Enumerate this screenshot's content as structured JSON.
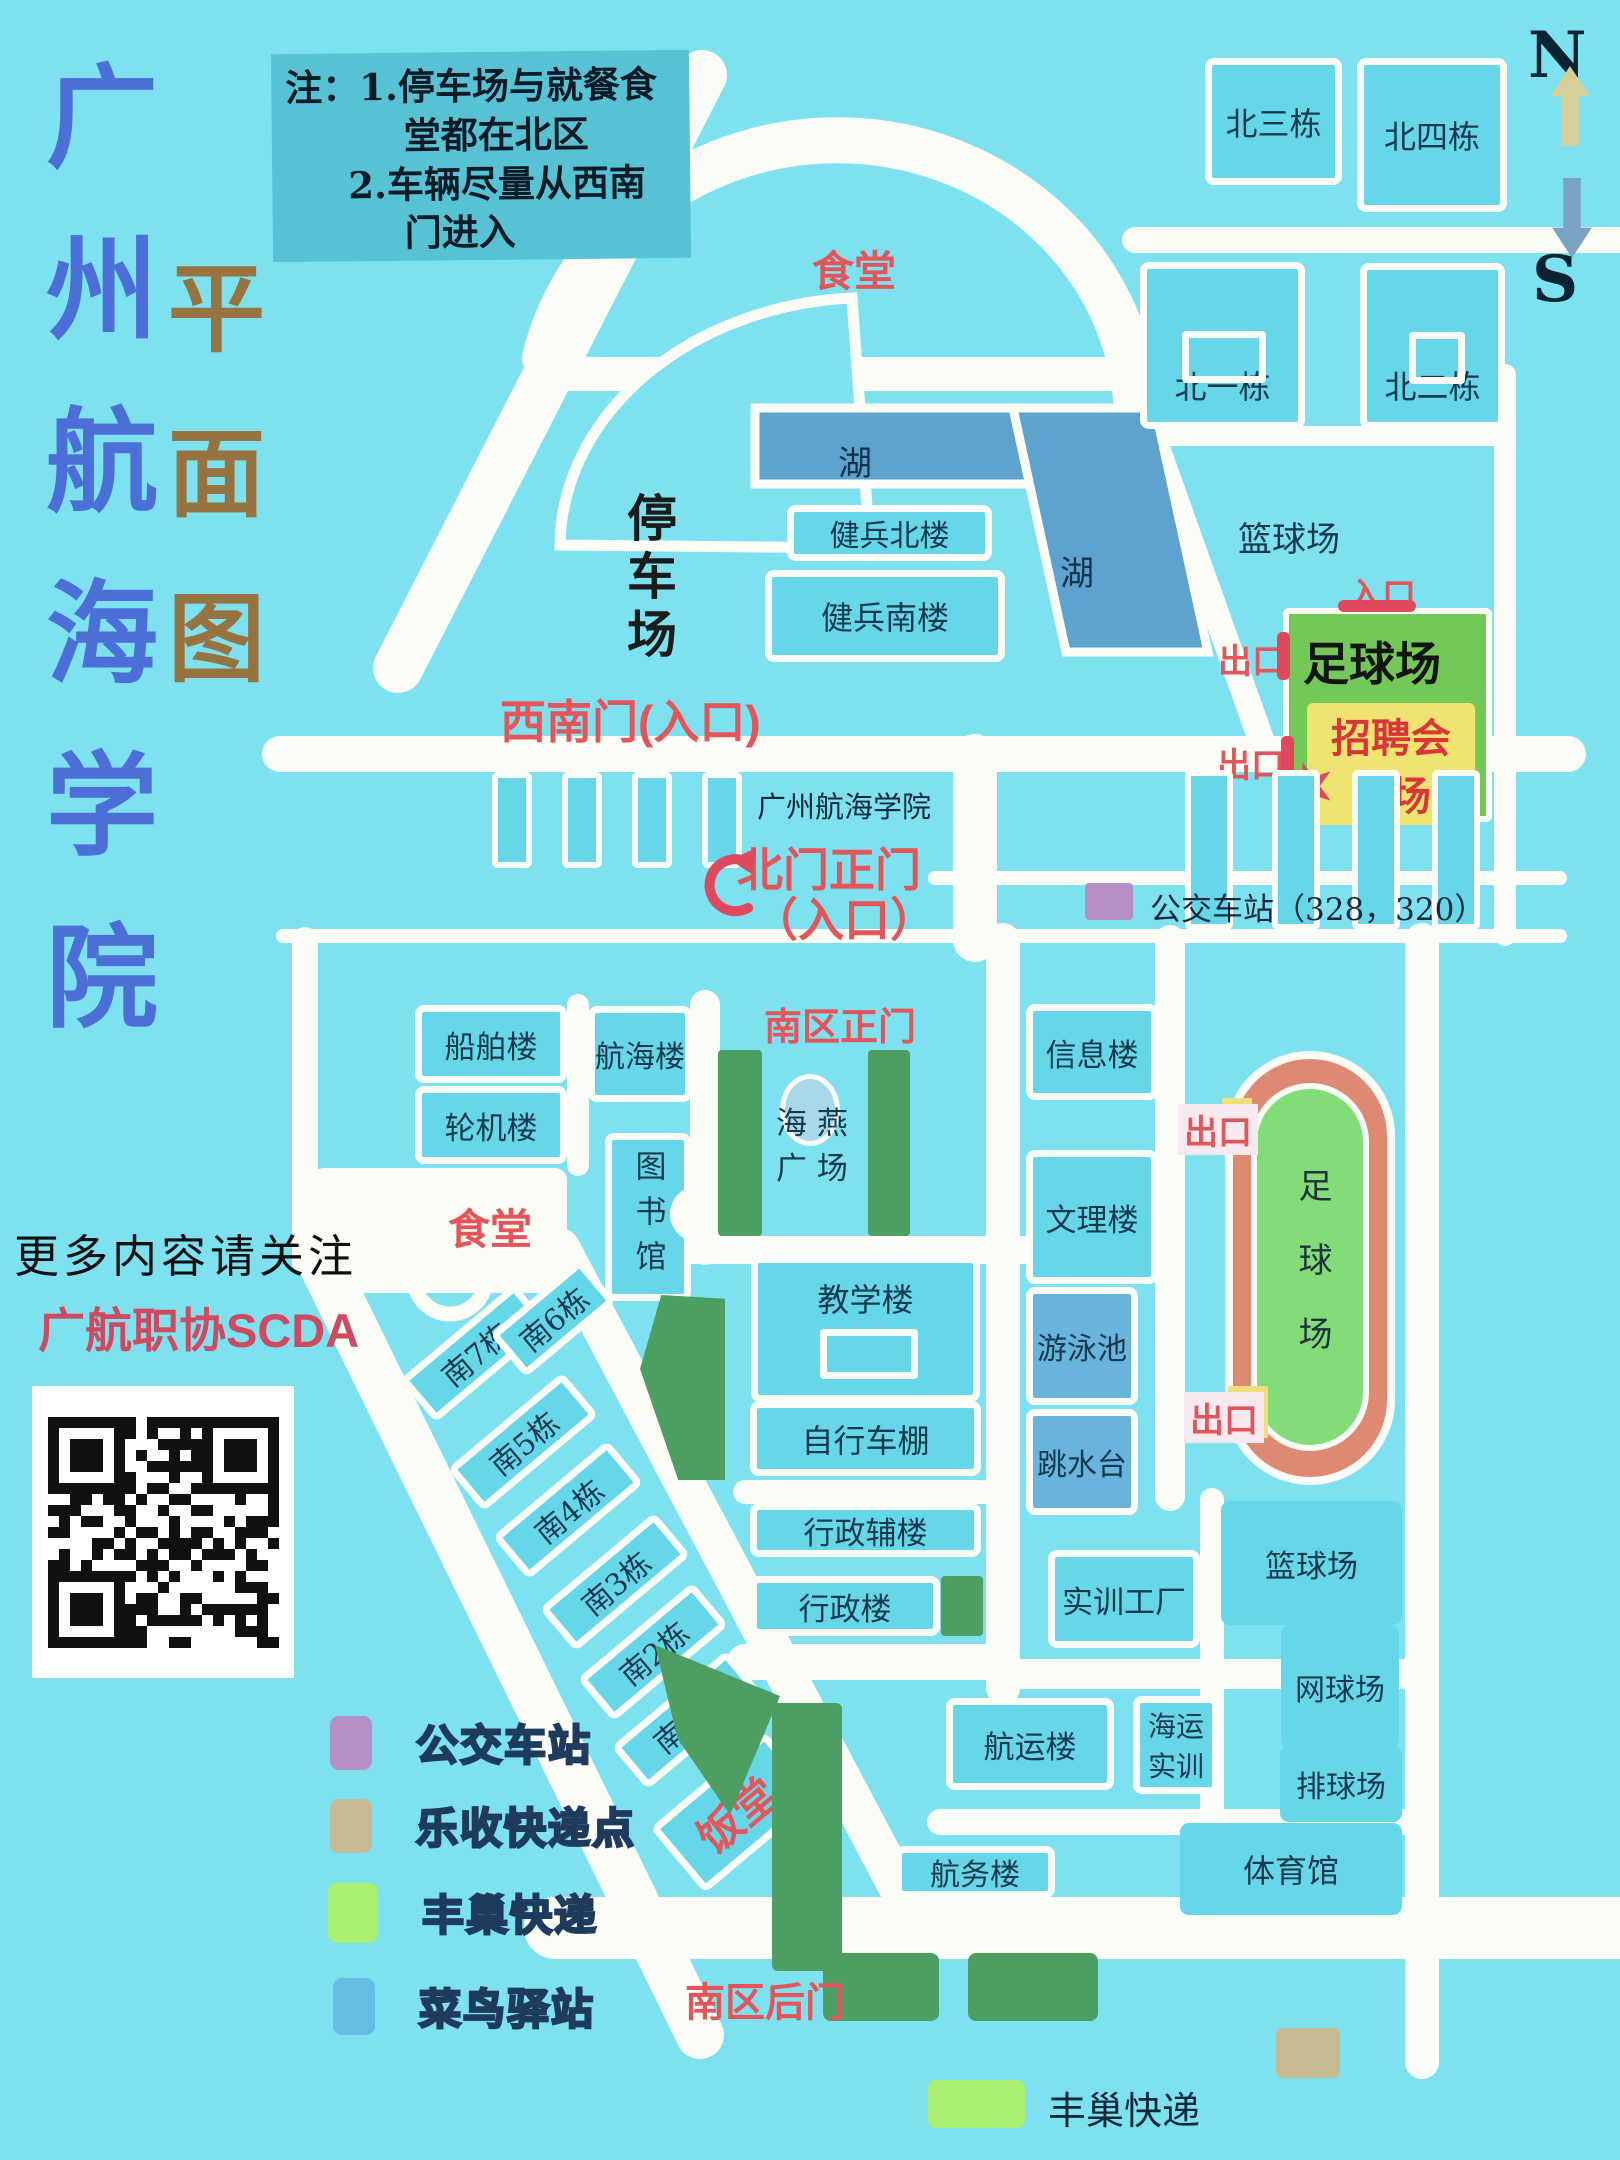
{
  "title": {
    "chars": [
      "广",
      "州",
      "航",
      "海",
      "学",
      "院"
    ],
    "sub": [
      "平",
      "面",
      "图"
    ]
  },
  "note": {
    "line1": "注：1.停车场与就餐食",
    "line2": "堂都在北区",
    "line3": "2.车辆尽量从西南",
    "line4": "门进入"
  },
  "compass": {
    "north": "N",
    "south": "S"
  },
  "north": {
    "canteen": "食堂",
    "parking": "停车场",
    "lake": "湖",
    "b_bei3": "北三栋",
    "b_bei4": "北四栋",
    "b_bei1": "北一栋",
    "b_bei2": "北二栋",
    "b_jianbing_north": "健兵北楼",
    "b_jianbing_south": "健兵南楼",
    "basketball": "篮球场",
    "football": "足球场",
    "jobfair_line1": "招聘会",
    "jobfair_line2": "会场",
    "entrance": "入口",
    "exit": "出口",
    "gate_sw": "西南门(入口)",
    "school_name": "广州航海学院",
    "gate_north_line1": "北门正门",
    "gate_north_line2": "（入口）",
    "bus_stop": "公交车站（328，320）"
  },
  "south": {
    "gate_main": "南区正门",
    "b_chuanbo": "船舶楼",
    "b_lunji": "轮机楼",
    "b_hanghai": "航海楼",
    "b_tushuguan": "图书馆",
    "b_xinxi": "信息楼",
    "plaza_line1": "海 燕",
    "plaza_line2": "广 场",
    "canteen": "食堂",
    "b_wenli": "文理楼",
    "b_jiaoxue": "教学楼",
    "pool": "游泳池",
    "bike_shed": "自行车棚",
    "dive_platform": "跳水台",
    "b_xingzhengfu": "行政辅楼",
    "b_xingzheng": "行政楼",
    "b_shixun": "实训工厂",
    "stadium": "足球场",
    "exit": "出口",
    "dorms": [
      "南7栋",
      "南6栋",
      "南5栋",
      "南4栋",
      "南3栋",
      "南2栋",
      "南1栋"
    ],
    "fantang": "饭堂",
    "b_hangyun": "航运楼",
    "b_haiyun_line1": "海运",
    "b_haiyun_line2": "实训",
    "basketball": "篮球场",
    "tennis": "网球场",
    "volleyball": "排球场",
    "gym": "体育馆",
    "b_hangwu": "航务楼",
    "gate_back": "南区后门",
    "fengchao_bottom": "丰巢快递"
  },
  "promo": {
    "line1": "更多内容请关注",
    "line2": "广航职协SCDA"
  },
  "legend": {
    "items": [
      {
        "label": "公交车站",
        "color": "#b58fc6"
      },
      {
        "label": "乐收快递点",
        "color": "#c6bb92"
      },
      {
        "label": "丰巢快递",
        "color": "#a9ef72"
      },
      {
        "label": "菜鸟驿站",
        "color": "#66bde4"
      }
    ]
  },
  "palette": {
    "background": "#7de1ef",
    "building": "#66d7e9",
    "road": "#fbfcf6",
    "lake": "#5ea2ce",
    "pool": "#68b4dd",
    "lawn": "#4d9e63",
    "track": "#de8a72",
    "infield": "#82dd78",
    "pitch": "#74c857",
    "jobfair_bg": "#efe46f",
    "red_label": "#e4555a",
    "title_blue": "#4b6fd6",
    "title_brown": "#97743f"
  }
}
